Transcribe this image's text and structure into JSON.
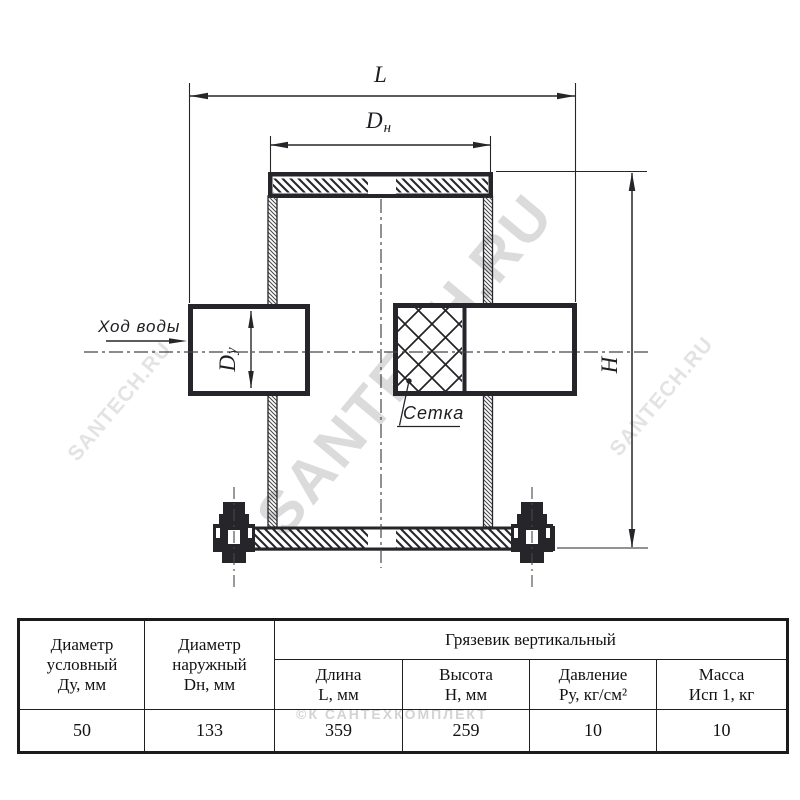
{
  "drawing": {
    "labels": {
      "length": "L",
      "outer_diameter_main": "D",
      "outer_diameter_sub": "н",
      "height_main": "H",
      "nominal_diameter_main": "D",
      "nominal_diameter_sub": "у",
      "flow_direction": "Ход воды",
      "mesh": "Сетка"
    }
  },
  "watermarks": {
    "brand_main": "SANTECH.RU",
    "brand_left": "SANTECH.RU",
    "brand_right": "SANTECH.RU",
    "table_stamp": "©К САНТЕХКОМПЛЕКТ"
  },
  "table": {
    "group_header": "Грязевик вертикальный",
    "columns": [
      {
        "header_lines": [
          "Диаметр",
          "условный",
          "Ду, мм"
        ],
        "value": "50"
      },
      {
        "header_lines": [
          "Диаметр",
          "наружный",
          "Dн, мм"
        ],
        "value": "133"
      },
      {
        "header_lines": [
          "Длина",
          "L, мм"
        ],
        "value": "359"
      },
      {
        "header_lines": [
          "Высота",
          "Н, мм"
        ],
        "value": "259"
      },
      {
        "header_lines": [
          "Давление",
          "Ру, кг/см²"
        ],
        "value": "10"
      },
      {
        "header_lines": [
          "Масса",
          "Исп 1, кг"
        ],
        "value": "10"
      }
    ]
  },
  "colors": {
    "line": "#26262a",
    "watermark": "#c4c4c4"
  }
}
